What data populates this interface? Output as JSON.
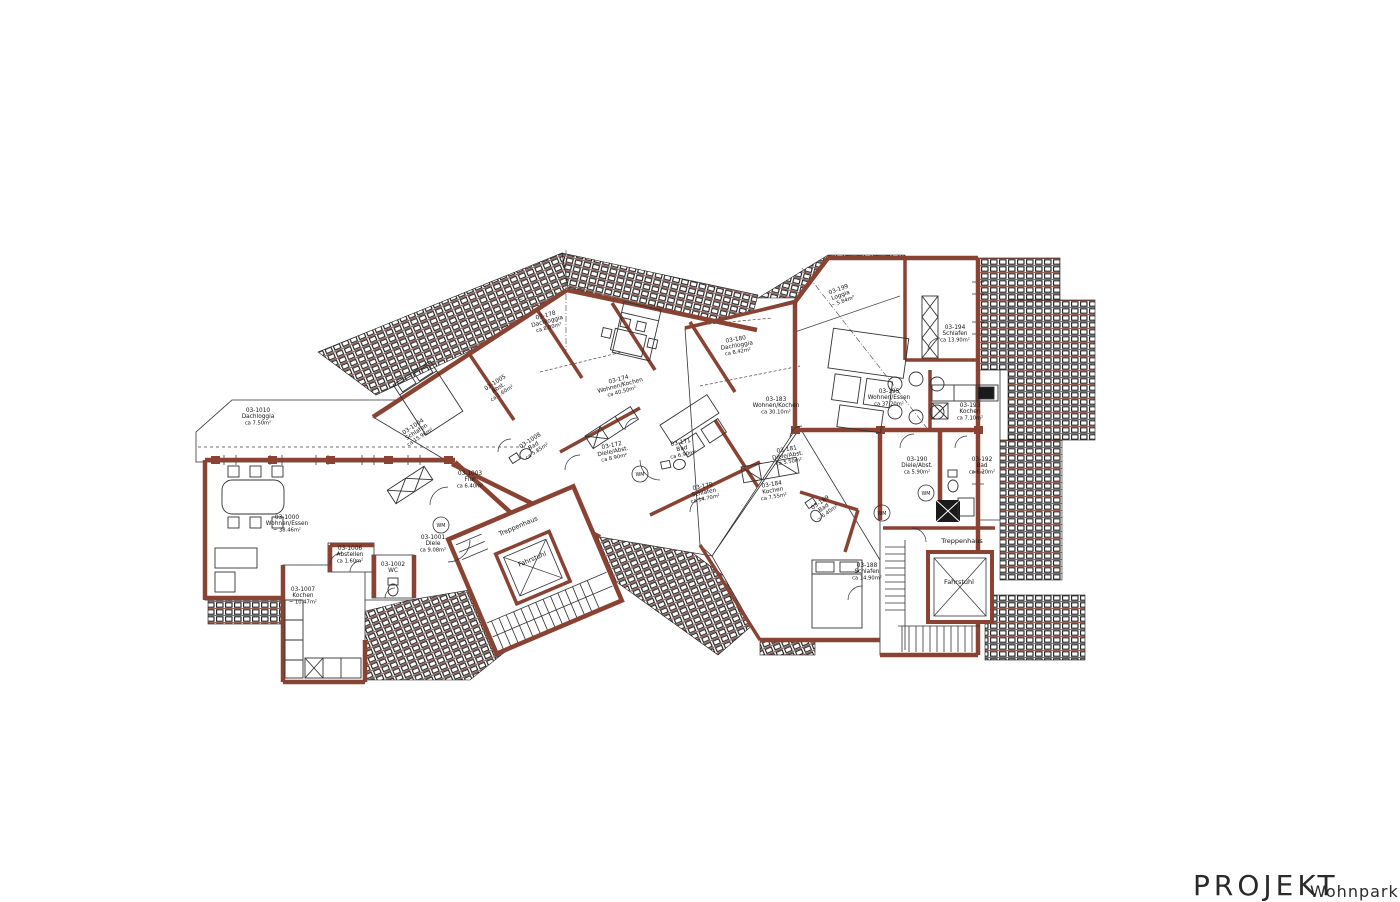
{
  "title_block": {
    "project_label": "PROJEKT",
    "project_name": "Wohnpark an"
  },
  "colors": {
    "wall": "#8a4232",
    "wall_light": "#b06a52",
    "line": "#1a1a1a",
    "background": "#ffffff"
  },
  "plan": {
    "wm_label": "WM",
    "wm_badges": [
      {
        "x": 441,
        "y": 525
      },
      {
        "x": 640,
        "y": 474
      },
      {
        "x": 882,
        "y": 513
      },
      {
        "x": 926,
        "y": 493
      }
    ],
    "rooms": [
      {
        "lines": [
          "03-1010",
          "Dachloggia",
          "ca 7.50m²"
        ],
        "x": 258,
        "y": 412,
        "rot": 0
      },
      {
        "lines": [
          "03-1000",
          "Wohnen/Essen",
          "~ 38.46m²"
        ],
        "x": 287,
        "y": 519,
        "rot": 0
      },
      {
        "lines": [
          "03-1006",
          "Abstellen",
          "ca 1.60m²"
        ],
        "x": 350,
        "y": 550,
        "rot": 0
      },
      {
        "lines": [
          "03-1002",
          "WC"
        ],
        "x": 393,
        "y": 566,
        "rot": 0
      },
      {
        "lines": [
          "03-1007",
          "Kochen",
          "~ 10.47m²"
        ],
        "x": 303,
        "y": 591,
        "rot": 0
      },
      {
        "lines": [
          "03-1001",
          "Diele",
          "ca 9.08m²"
        ],
        "x": 433,
        "y": 539,
        "rot": 0
      },
      {
        "lines": [
          "03-1003",
          "Flur",
          "ca 6.40m²"
        ],
        "x": 470,
        "y": 475,
        "rot": 0
      },
      {
        "lines": [
          "03-1004",
          "Schlafen",
          "ca 15.96m²"
        ],
        "x": 414,
        "y": 428,
        "rot": -33
      },
      {
        "lines": [
          "03-1005",
          "Abst.",
          "ca 1.60m²"
        ],
        "x": 496,
        "y": 384,
        "rot": -33
      },
      {
        "lines": [
          "03-1008",
          "Bad",
          "ca 5.85m²"
        ],
        "x": 531,
        "y": 442,
        "rot": -33
      },
      {
        "lines": [
          "03-178",
          "Dachloggia",
          "ca 8.00m²"
        ],
        "x": 546,
        "y": 317,
        "rot": -15
      },
      {
        "lines": [
          "03-174",
          "Wohnen/Kochen",
          "ca 40.50m²"
        ],
        "x": 619,
        "y": 381,
        "rot": -15
      },
      {
        "lines": [
          "03-172",
          "Diele/Abst.",
          "ca 8.90m²"
        ],
        "x": 612,
        "y": 447,
        "rot": -12
      },
      {
        "lines": [
          "03-171",
          "Bad",
          "ca 6.90m²"
        ],
        "x": 681,
        "y": 444,
        "rot": -12
      },
      {
        "lines": [
          "03-170",
          "Schlafen",
          "ca 14.70m²"
        ],
        "x": 703,
        "y": 488,
        "rot": -12
      },
      {
        "lines": [
          "03-180",
          "Dachloggia",
          "ca 8.42m²"
        ],
        "x": 736,
        "y": 341,
        "rot": -10
      },
      {
        "lines": [
          "03-183",
          "Wohnen/Kochen",
          "ca 30.10m²"
        ],
        "x": 776,
        "y": 401,
        "rot": 0
      },
      {
        "lines": [
          "03-181",
          "Diele/Abst.",
          "ca 5.50m²"
        ],
        "x": 787,
        "y": 451,
        "rot": -10
      },
      {
        "lines": [
          "03-184",
          "Kochen",
          "ca 7.55m²"
        ],
        "x": 772,
        "y": 486,
        "rot": -10
      },
      {
        "lines": [
          "03-189",
          "Bad",
          "~ 6.40m²"
        ],
        "x": 821,
        "y": 504,
        "rot": -35
      },
      {
        "lines": [
          "03-188",
          "Schlafen",
          "ca 14.90m²"
        ],
        "x": 867,
        "y": 567,
        "rot": 0
      },
      {
        "lines": [
          "03-199",
          "Loggia",
          "~ 5.84m²"
        ],
        "x": 839,
        "y": 291,
        "rot": -20
      },
      {
        "lines": [
          "03-194",
          "Schlafen",
          "ca 13.90m²"
        ],
        "x": 955,
        "y": 329,
        "rot": 0
      },
      {
        "lines": [
          "03-195",
          "Wohnen/Essen",
          "ca 37.20m²"
        ],
        "x": 889,
        "y": 393,
        "rot": 0
      },
      {
        "lines": [
          "03-193",
          "Kochen",
          "ca 7.10m²"
        ],
        "x": 970,
        "y": 407,
        "rot": 0
      },
      {
        "lines": [
          "03-190",
          "Diele/Abst.",
          "ca 5.90m²"
        ],
        "x": 917,
        "y": 461,
        "rot": 0
      },
      {
        "lines": [
          "03-192",
          "Bad",
          "ca 6.20m²"
        ],
        "x": 982,
        "y": 461,
        "rot": 0
      },
      {
        "lines": [
          "Treppenhaus"
        ],
        "x": 519,
        "y": 528,
        "rot": -23,
        "size": 6.5
      },
      {
        "lines": [
          "Fahrstuhl"
        ],
        "x": 533,
        "y": 561,
        "rot": -23,
        "size": 6.5
      },
      {
        "lines": [
          "Treppenhaus"
        ],
        "x": 962,
        "y": 543,
        "rot": 0,
        "size": 6.5
      },
      {
        "lines": [
          "Fahrstuhl"
        ],
        "x": 959,
        "y": 584,
        "rot": 0,
        "size": 6.5
      }
    ]
  }
}
